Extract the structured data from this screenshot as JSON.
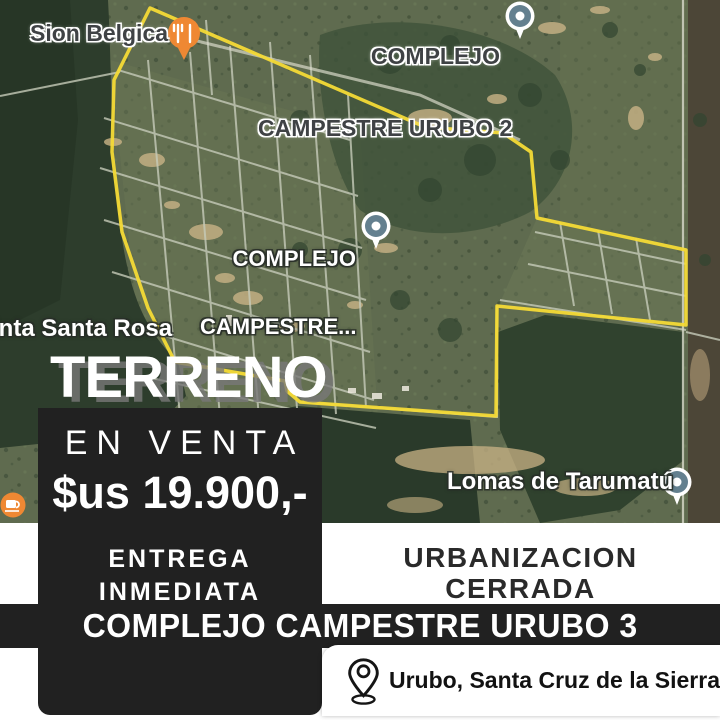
{
  "map": {
    "labels": {
      "sion_belgica": "Sion Belgica",
      "urubo2_line1": "COMPLEJO",
      "urubo2_line2": "CAMPESTRE URUBO 2",
      "complejo_line1": "COMPLEJO",
      "complejo_line2": "CAMPESTRE...",
      "santa_rosa": "inta Santa Rosa",
      "lomas": "Lomas de Tarumatú"
    },
    "boundary_color": "#f4da36",
    "pin_colors": {
      "poi_orange": "#ef8833",
      "place_slate": "#64808f"
    }
  },
  "ad": {
    "headline": "TERRENO",
    "sale_label": "EN VENTA",
    "price": "$us 19.900,-",
    "delivery_line1": "ENTREGA",
    "delivery_line2": "INMEDIATA",
    "feature_line1": "URBANIZACION",
    "feature_line2": "CERRADA",
    "project_name": "COMPLEJO CAMPESTRE URUBO 3",
    "location": "Urubo, Santa Cruz de la Sierra",
    "panel_color": "#212121"
  }
}
